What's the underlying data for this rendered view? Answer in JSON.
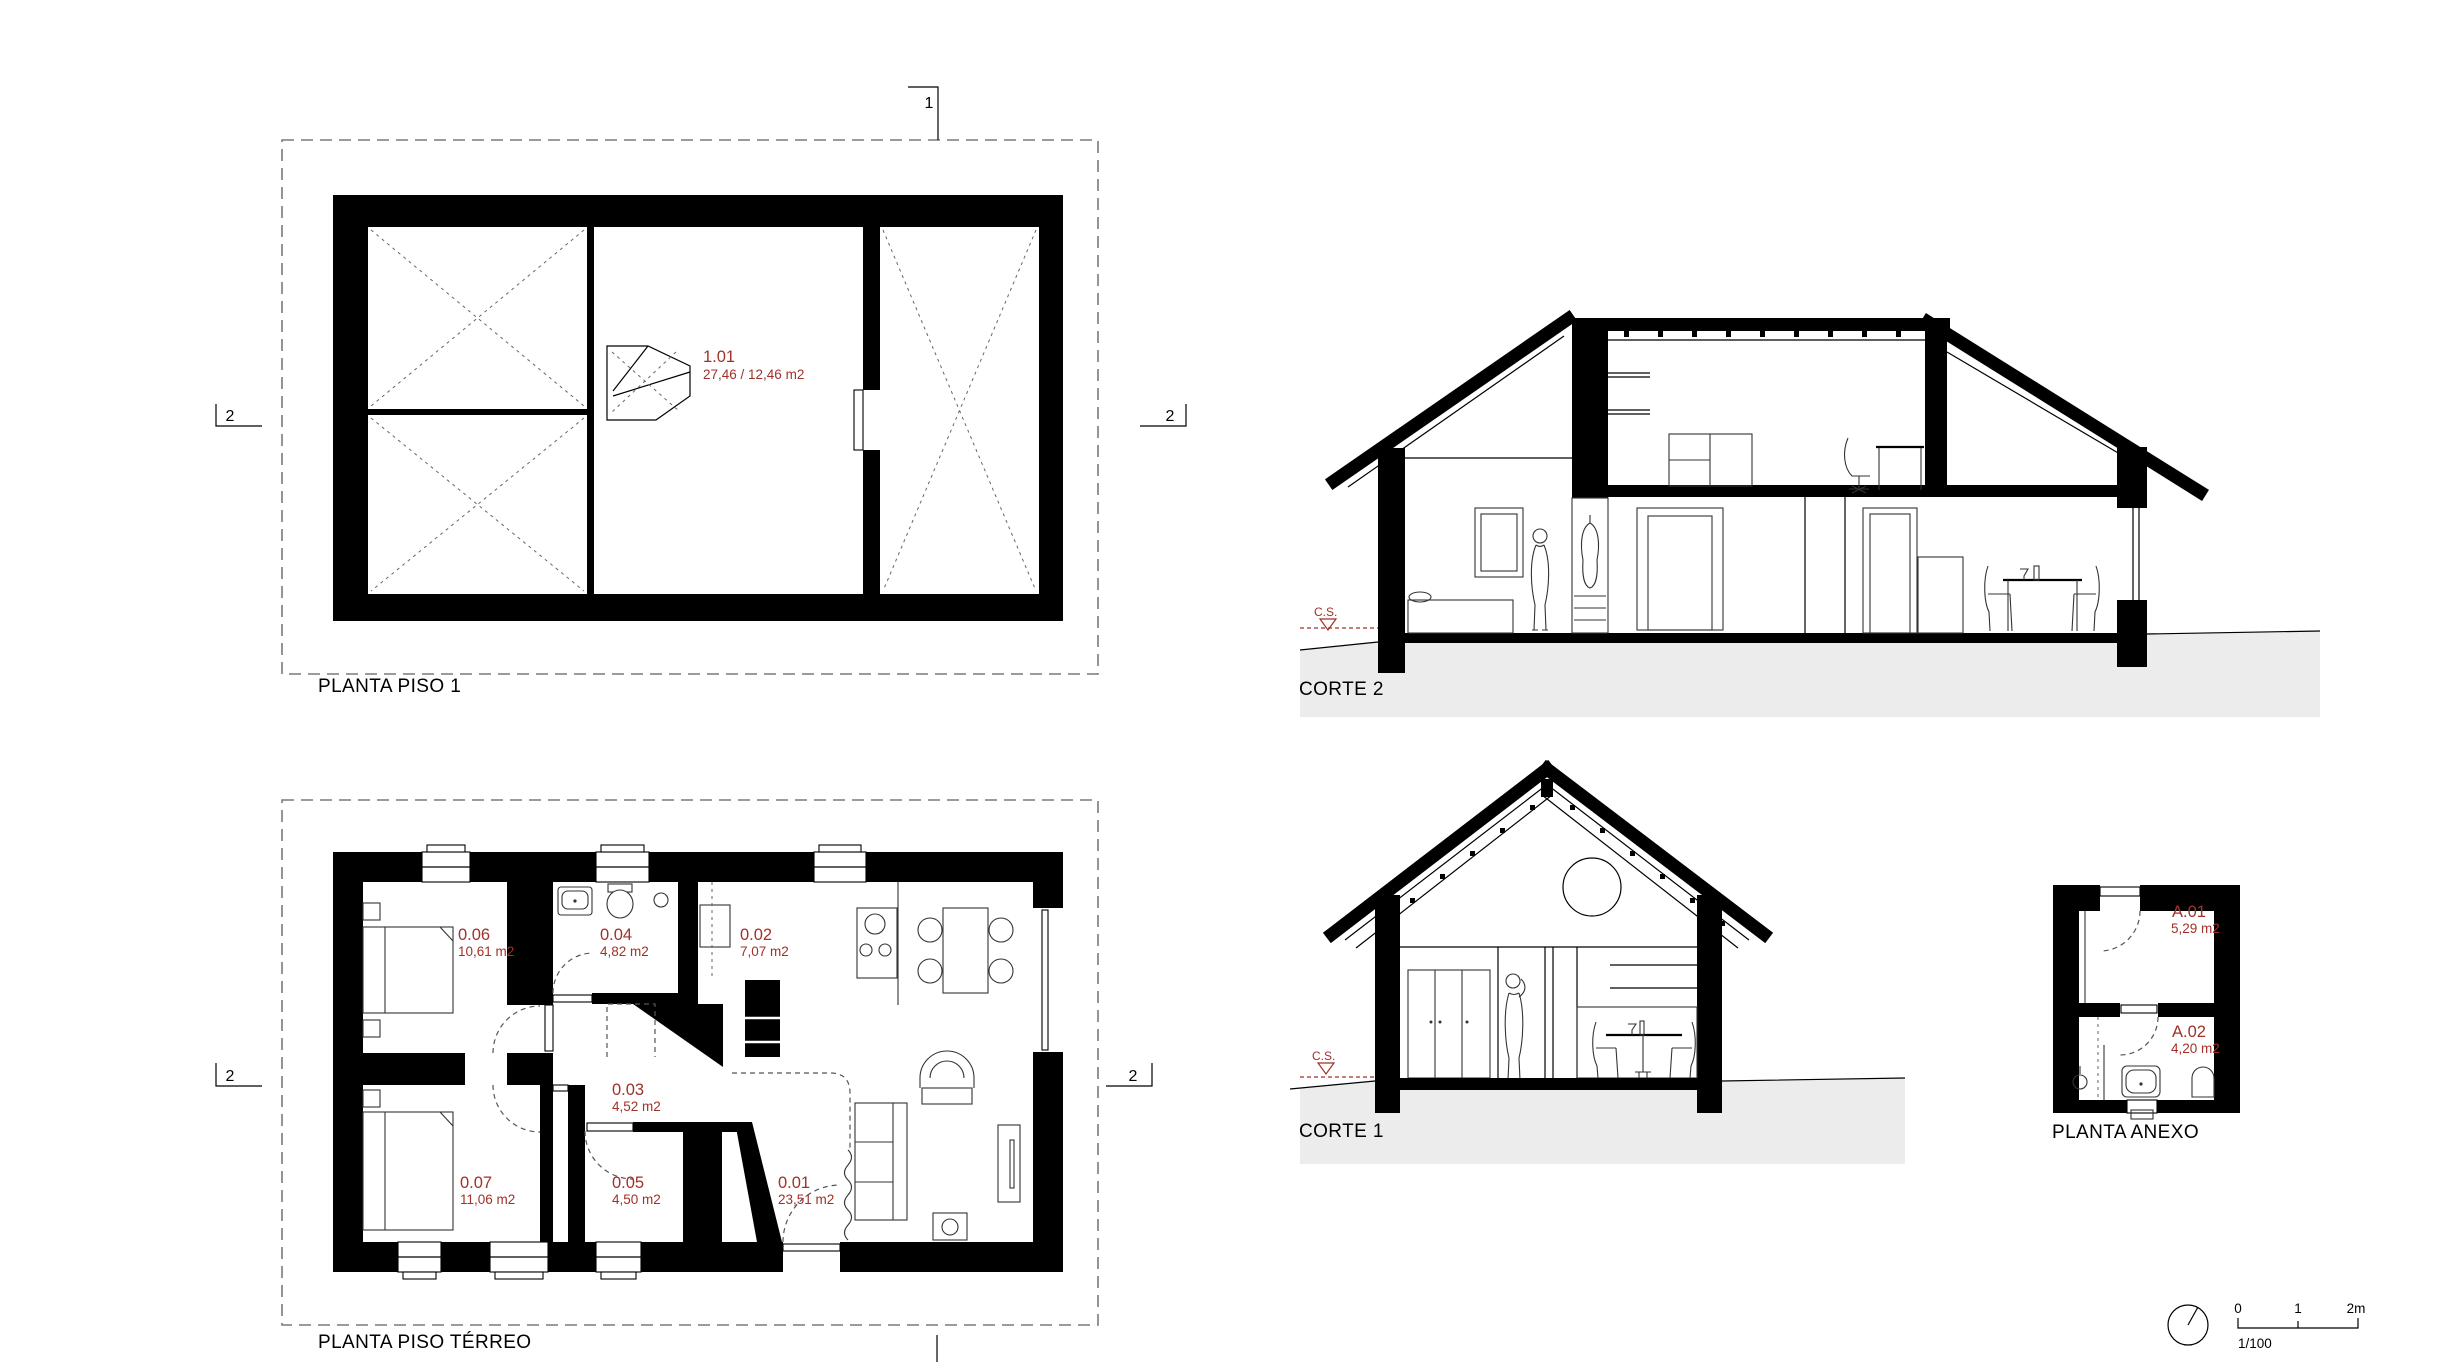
{
  "colors": {
    "accent_red": "#a03229",
    "ground_gray": "#ececec",
    "line_black": "#000000"
  },
  "drawings": {
    "planta_piso_1": {
      "title": "PLANTA PISO 1",
      "room": {
        "id": "1.01",
        "area": "27,46 / 12,46 m2"
      }
    },
    "planta_piso_terreo": {
      "title": "PLANTA PISO TÉRREO",
      "rooms": [
        {
          "id": "0.06",
          "area": "10,61 m2"
        },
        {
          "id": "0.04",
          "area": "4,82 m2"
        },
        {
          "id": "0.02",
          "area": "7,07 m2"
        },
        {
          "id": "0.03",
          "area": "4,52 m2"
        },
        {
          "id": "0.07",
          "area": "11,06 m2"
        },
        {
          "id": "0.05",
          "area": "4,50 m2"
        },
        {
          "id": "0.01",
          "area": "23,51 m2"
        }
      ]
    },
    "corte_2": {
      "title": "CORTE 2",
      "datum_label": "C.S."
    },
    "corte_1": {
      "title": "CORTE 1",
      "datum_label": "C.S."
    },
    "planta_anexo": {
      "title": "PLANTA ANEXO",
      "rooms": [
        {
          "id": "A.01",
          "area": "5,29 m2"
        },
        {
          "id": "A.02",
          "area": "4,20 m2"
        }
      ]
    }
  },
  "section_markers": {
    "line_1": "1",
    "line_2": "2"
  },
  "scale_bar": {
    "tick_0": "0",
    "tick_1": "1",
    "tick_2": "2m",
    "scale": "1/100"
  }
}
